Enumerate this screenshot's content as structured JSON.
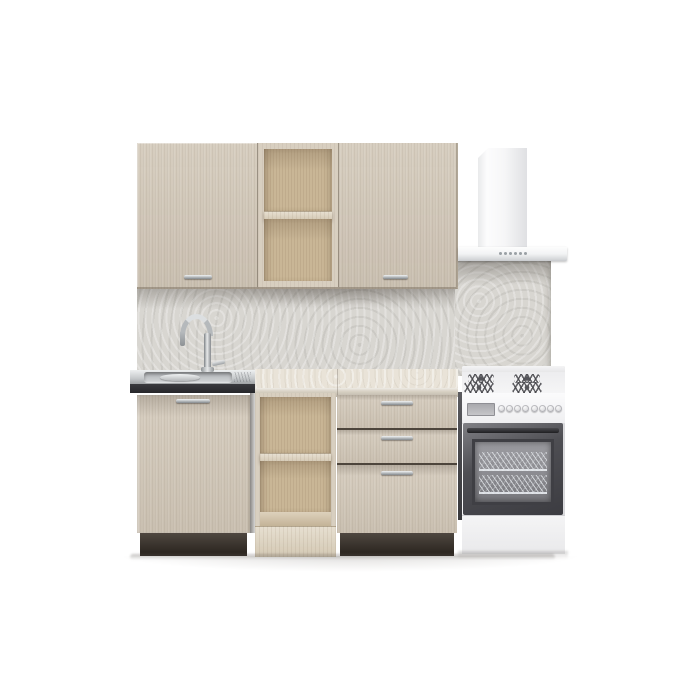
{
  "scene": {
    "description": "3D product render of a compact beige wood kitchen set on a white background",
    "parts": [
      "upper-cabinet-left-door",
      "upper-open-shelf-unit",
      "upper-cabinet-right-door",
      "range-hood",
      "stone-backsplash",
      "stainless-sink",
      "gooseneck-faucet",
      "sink-base-cabinet",
      "marble-countertop",
      "open-base-shelf-unit",
      "three-drawer-unit",
      "gas-stove-with-oven"
    ],
    "counts": {
      "upper_doors": 2,
      "upper_shelf_compartments": 2,
      "hood_buttons": 6,
      "lower_doors": 1,
      "lower_shelf_compartments": 2,
      "drawers": 3,
      "stove_burners": 4,
      "stove_knobs": 8,
      "oven_racks": 2
    }
  },
  "colors": {
    "background": "#ffffff",
    "cabinet-wood": "#d3c9ba",
    "cabinet-wood-frame": "#d8cfc0",
    "shelf-interior-wood": "#c9b696",
    "shelf-base-wood": "#ded4c0",
    "plinth-wenge": "#362e26",
    "backsplash-stone": "#d8d6d1",
    "countertop-marble": "#e9e3d8",
    "countertop-front": "#d9d2c5",
    "sink-steel": "#c6c9cb",
    "sink-front-edge": "#26262a",
    "chrome": "#b5b9bc",
    "hood-white": "#f2f3f4",
    "stove-white": "#f7f7f8",
    "stove-side": "#4a4a4e",
    "oven-frame": "#4e4e53",
    "oven-glass": "#8d8d92",
    "burner-grate": "#55555a",
    "knob-gray": "#d9d9dc",
    "floor-shadow": "#b9b5b0"
  }
}
